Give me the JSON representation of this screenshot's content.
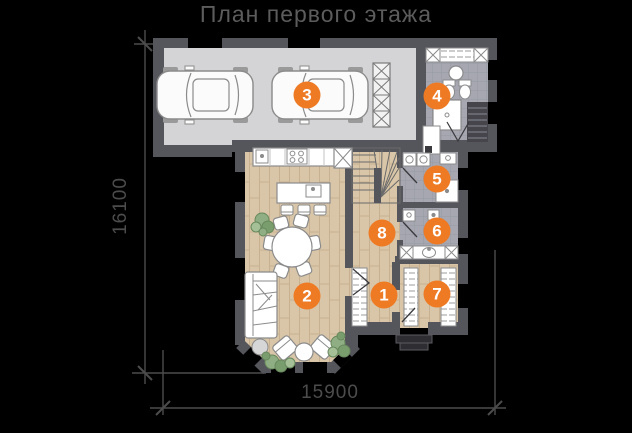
{
  "title": "План первого этажа",
  "dimensions": {
    "height_mm": "16100",
    "width_mm": "15900"
  },
  "markers": [
    {
      "label": "1",
      "x": 384,
      "y": 295
    },
    {
      "label": "2",
      "x": 307,
      "y": 296
    },
    {
      "label": "3",
      "x": 307,
      "y": 95
    },
    {
      "label": "4",
      "x": 437,
      "y": 96
    },
    {
      "label": "5",
      "x": 437,
      "y": 179
    },
    {
      "label": "6",
      "x": 437,
      "y": 231
    },
    {
      "label": "7",
      "x": 437,
      "y": 294
    },
    {
      "label": "8",
      "x": 382,
      "y": 233
    }
  ],
  "colors": {
    "background": "#000000",
    "accent": "#ee7a24",
    "wall": "#55555c",
    "garage_floor": "#d4d4d6",
    "tile_floor": "#a6a7b1",
    "wood_floor": "#d9c6a8",
    "title_text": "#5c5c5c",
    "dimension_lines": "#4c4c4c"
  }
}
